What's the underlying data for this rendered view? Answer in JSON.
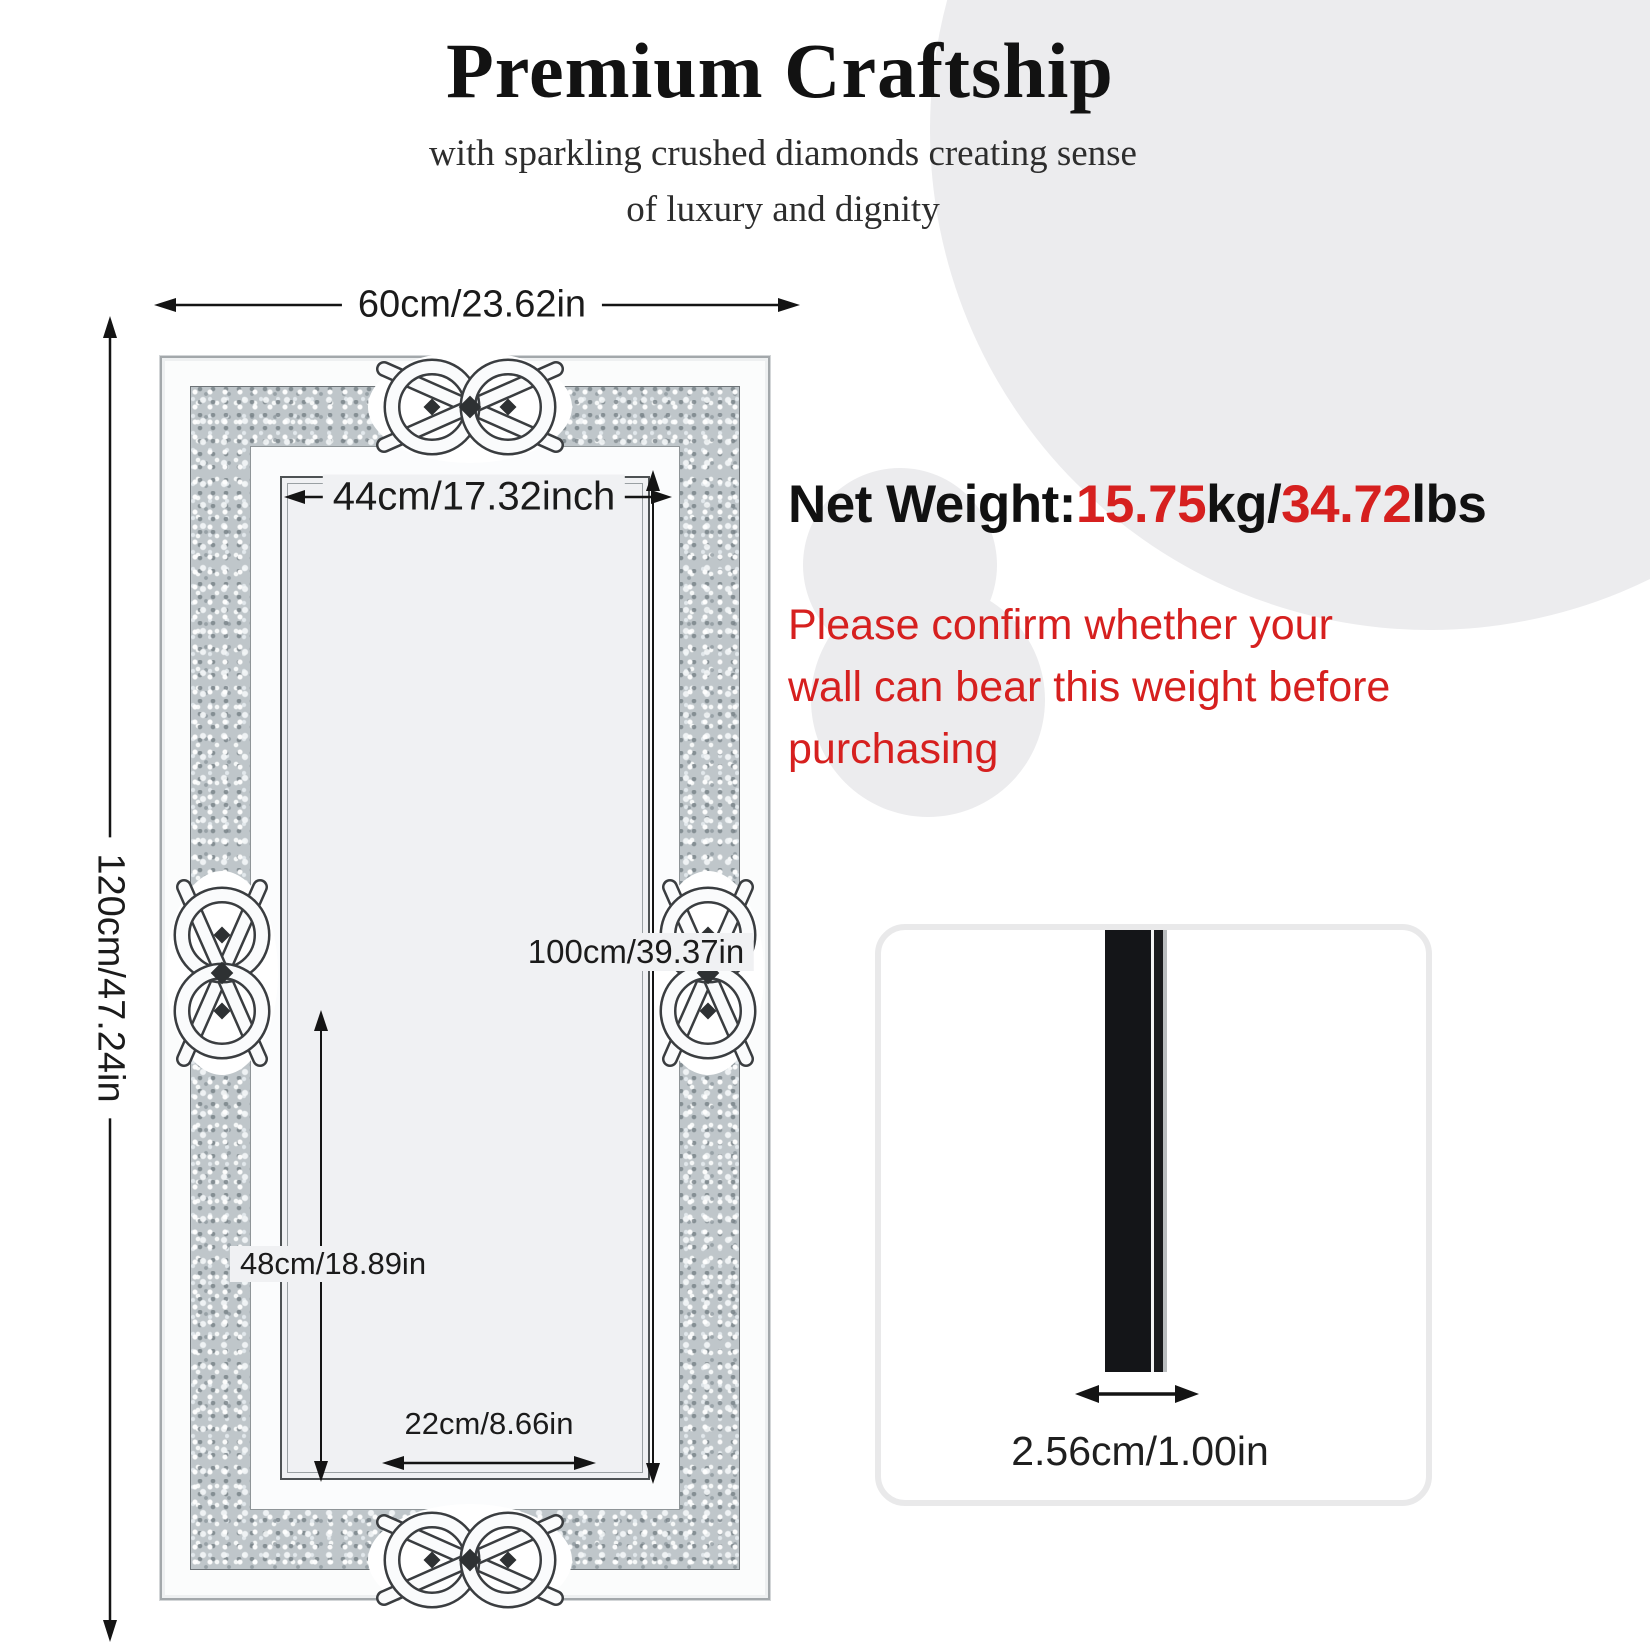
{
  "header": {
    "title": "Premium Craftship",
    "subtitle": [
      "with sparkling crushed diamonds creating sense",
      "of luxury and dignity"
    ]
  },
  "weight": {
    "label": "Net Weight:",
    "kg_value": "15.75",
    "kg_unit": "kg/",
    "lbs_value": "34.72",
    "lbs_unit": "lbs"
  },
  "warning": {
    "text": "Please confirm whether your wall can bear this weight before purchasing",
    "lines": [
      "Please confirm whether your",
      "wall can bear this weight before",
      "purchasing"
    ]
  },
  "dimensions": {
    "overall_width": "60cm/23.62in",
    "overall_height": "120cm/47.24in",
    "inner_width": "44cm/17.32inch",
    "inner_height": "100cm/39.37in",
    "lower_height": "48cm/18.89in",
    "bottom_width": "22cm/8.66in",
    "thickness": "2.56cm/1.00in"
  },
  "colors": {
    "accent_red": "#d6201f",
    "background_circle_gray": "#ececee",
    "diamond_band_gray": "#bfc6ca",
    "side_bar_black": "#141518"
  }
}
